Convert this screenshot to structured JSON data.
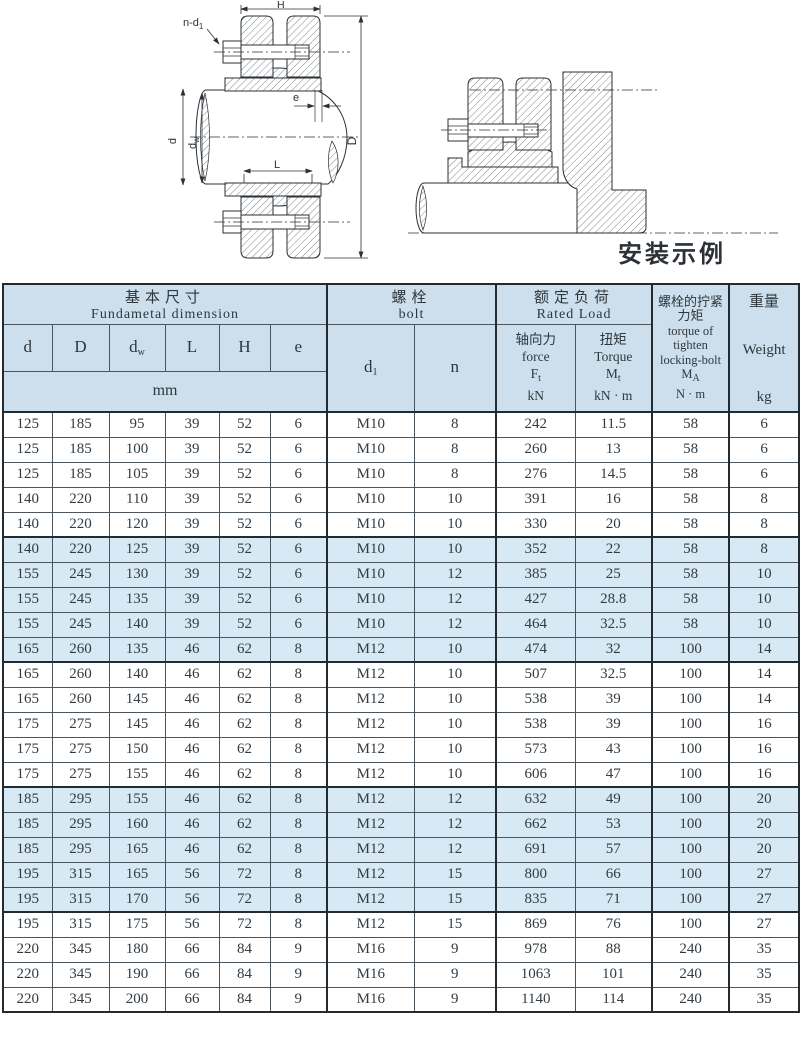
{
  "colors": {
    "accent_navy": "#1d1d7c",
    "header_bg": "#cddfec",
    "shaded_row_bg": "#d7e9f4",
    "grid_thin": "#4a555d",
    "grid_thick": "#232b30"
  },
  "drawings": {
    "left": {
      "labels": {
        "H": "H",
        "n_d1_b": "n-d",
        "n_d1_s": "1",
        "d": "d",
        "dw_b": "d",
        "dw_s": "w",
        "L": "L",
        "D": "D",
        "e": "e"
      }
    },
    "right": {
      "caption": "安装示例"
    }
  },
  "table": {
    "header": {
      "fundamental": {
        "zh": "基本尺寸",
        "en": "Fundametal dimension"
      },
      "bolt": {
        "zh": "螺栓",
        "en": "bolt"
      },
      "rated": {
        "zh": "额定负荷",
        "en": "Rated Load"
      },
      "cols": {
        "d": {
          "b": "d",
          "s": ""
        },
        "D": {
          "b": "D",
          "s": ""
        },
        "dw": {
          "b": "d",
          "s": "w"
        },
        "L": {
          "b": "L",
          "s": ""
        },
        "H": {
          "b": "H",
          "s": ""
        },
        "e": {
          "b": "e",
          "s": ""
        },
        "d1": {
          "b": "d",
          "s": "1"
        },
        "n": {
          "b": "n",
          "s": ""
        }
      },
      "force": {
        "zh": "轴向力",
        "en": "force",
        "sym_b": "F",
        "sym_s": "t",
        "unit": "kN"
      },
      "torque": {
        "zh": "扭矩",
        "en": "Torque",
        "sym_b": "M",
        "sym_s": "t",
        "unit": "kN · m"
      },
      "tighten": {
        "zh1": "螺栓的拧紧",
        "zh2": "力矩",
        "en1": "torque of",
        "en2": "tighten",
        "en3": "locking-bolt",
        "sym_b": "M",
        "sym_s": "A",
        "unit": "N · m"
      },
      "weight": {
        "zh": "重量",
        "en": "Weight",
        "unit": "kg"
      },
      "mm": "mm"
    },
    "rows": [
      {
        "v": [
          "125",
          "185",
          "95",
          "39",
          "52",
          "6",
          "M10",
          "8",
          "242",
          "11.5",
          "58",
          "6"
        ],
        "shaded": false
      },
      {
        "v": [
          "125",
          "185",
          "100",
          "39",
          "52",
          "6",
          "M10",
          "8",
          "260",
          "13",
          "58",
          "6"
        ],
        "shaded": false
      },
      {
        "v": [
          "125",
          "185",
          "105",
          "39",
          "52",
          "6",
          "M10",
          "8",
          "276",
          "14.5",
          "58",
          "6"
        ],
        "shaded": false
      },
      {
        "v": [
          "140",
          "220",
          "110",
          "39",
          "52",
          "6",
          "M10",
          "10",
          "391",
          "16",
          "58",
          "8"
        ],
        "shaded": false
      },
      {
        "v": [
          "140",
          "220",
          "120",
          "39",
          "52",
          "6",
          "M10",
          "10",
          "330",
          "20",
          "58",
          "8"
        ],
        "shaded": false
      },
      {
        "v": [
          "140",
          "220",
          "125",
          "39",
          "52",
          "6",
          "M10",
          "10",
          "352",
          "22",
          "58",
          "8"
        ],
        "shaded": true
      },
      {
        "v": [
          "155",
          "245",
          "130",
          "39",
          "52",
          "6",
          "M10",
          "12",
          "385",
          "25",
          "58",
          "10"
        ],
        "shaded": true
      },
      {
        "v": [
          "155",
          "245",
          "135",
          "39",
          "52",
          "6",
          "M10",
          "12",
          "427",
          "28.8",
          "58",
          "10"
        ],
        "shaded": true
      },
      {
        "v": [
          "155",
          "245",
          "140",
          "39",
          "52",
          "6",
          "M10",
          "12",
          "464",
          "32.5",
          "58",
          "10"
        ],
        "shaded": true
      },
      {
        "v": [
          "165",
          "260",
          "135",
          "46",
          "62",
          "8",
          "M12",
          "10",
          "474",
          "32",
          "100",
          "14"
        ],
        "shaded": true
      },
      {
        "v": [
          "165",
          "260",
          "140",
          "46",
          "62",
          "8",
          "M12",
          "10",
          "507",
          "32.5",
          "100",
          "14"
        ],
        "shaded": false
      },
      {
        "v": [
          "165",
          "260",
          "145",
          "46",
          "62",
          "8",
          "M12",
          "10",
          "538",
          "39",
          "100",
          "14"
        ],
        "shaded": false
      },
      {
        "v": [
          "175",
          "275",
          "145",
          "46",
          "62",
          "8",
          "M12",
          "10",
          "538",
          "39",
          "100",
          "16"
        ],
        "shaded": false
      },
      {
        "v": [
          "175",
          "275",
          "150",
          "46",
          "62",
          "8",
          "M12",
          "10",
          "573",
          "43",
          "100",
          "16"
        ],
        "shaded": false
      },
      {
        "v": [
          "175",
          "275",
          "155",
          "46",
          "62",
          "8",
          "M12",
          "10",
          "606",
          "47",
          "100",
          "16"
        ],
        "shaded": false
      },
      {
        "v": [
          "185",
          "295",
          "155",
          "46",
          "62",
          "8",
          "M12",
          "12",
          "632",
          "49",
          "100",
          "20"
        ],
        "shaded": true
      },
      {
        "v": [
          "185",
          "295",
          "160",
          "46",
          "62",
          "8",
          "M12",
          "12",
          "662",
          "53",
          "100",
          "20"
        ],
        "shaded": true
      },
      {
        "v": [
          "185",
          "295",
          "165",
          "46",
          "62",
          "8",
          "M12",
          "12",
          "691",
          "57",
          "100",
          "20"
        ],
        "shaded": true
      },
      {
        "v": [
          "195",
          "315",
          "165",
          "56",
          "72",
          "8",
          "M12",
          "15",
          "800",
          "66",
          "100",
          "27"
        ],
        "shaded": true
      },
      {
        "v": [
          "195",
          "315",
          "170",
          "56",
          "72",
          "8",
          "M12",
          "15",
          "835",
          "71",
          "100",
          "27"
        ],
        "shaded": true
      },
      {
        "v": [
          "195",
          "315",
          "175",
          "56",
          "72",
          "8",
          "M12",
          "15",
          "869",
          "76",
          "100",
          "27"
        ],
        "shaded": false
      },
      {
        "v": [
          "220",
          "345",
          "180",
          "66",
          "84",
          "9",
          "M16",
          "9",
          "978",
          "88",
          "240",
          "35"
        ],
        "shaded": false
      },
      {
        "v": [
          "220",
          "345",
          "190",
          "66",
          "84",
          "9",
          "M16",
          "9",
          "1063",
          "101",
          "240",
          "35"
        ],
        "shaded": false
      },
      {
        "v": [
          "220",
          "345",
          "200",
          "66",
          "84",
          "9",
          "M16",
          "9",
          "1140",
          "114",
          "240",
          "35"
        ],
        "shaded": false
      }
    ]
  }
}
